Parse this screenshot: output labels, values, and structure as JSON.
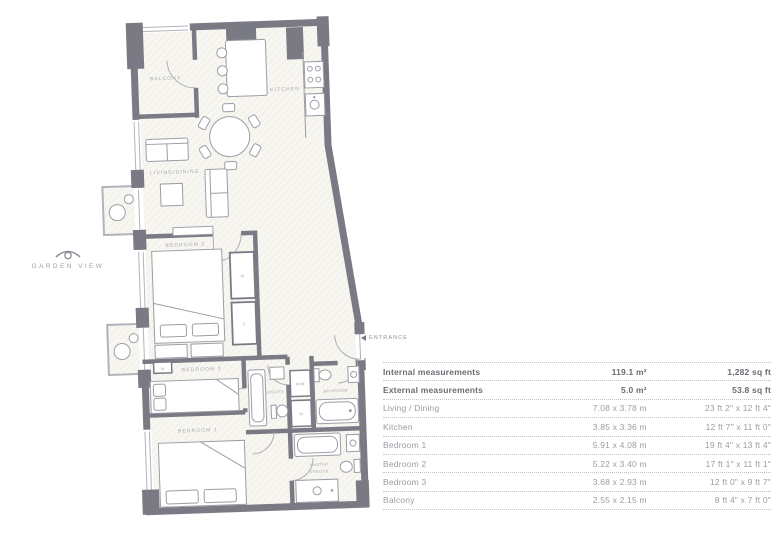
{
  "annotations": {
    "garden_view": "GARDEN VIEW",
    "entrance": "ENTRANCE"
  },
  "floorplan": {
    "rooms": {
      "balcony": "BALCONY",
      "kitchen": "KITCHEN",
      "living_dining": "LIVING/DINING",
      "bedroom2": "BEDROOM 2",
      "bedroom3": "BEDROOM 3",
      "ensuite": "ENSUITE",
      "bathroom": "BATHROOM",
      "bedroom1": "BEDROOM 1",
      "master_line1": "MASTER",
      "master_line2": "ENSUITE"
    },
    "markers": {
      "wardrobe_bed2": "W",
      "cupboard_bed2": "C",
      "wardrobe_bed3": "W",
      "washer": "W/M",
      "wardrobe_hall": "W"
    }
  },
  "table": {
    "rows": [
      {
        "name": "Internal measurements",
        "metric": "119.1 m²",
        "imperial": "1,282 sq ft"
      },
      {
        "name": "External measurements",
        "metric": "5.0 m²",
        "imperial": "53.8 sq ft"
      },
      {
        "name": "Living / Dining",
        "metric": "7.08 x 3.78 m",
        "imperial": "23 ft 2\" x 12 ft 4\""
      },
      {
        "name": "Kitchen",
        "metric": "3.85 x 3.36 m",
        "imperial": "12 ft 7\" x 11 ft 0\""
      },
      {
        "name": "Bedroom 1",
        "metric": "5.91 x 4.08 m",
        "imperial": "19 ft 4\" x 13 ft 4\""
      },
      {
        "name": "Bedroom 2",
        "metric": "5.22 x 3.40 m",
        "imperial": "17 ft 1\" x 11 ft 1\""
      },
      {
        "name": "Bedroom 3",
        "metric": "3.68 x 2.93 m",
        "imperial": "12 ft 0\" x 9 ft 7\""
      },
      {
        "name": "Balcony",
        "metric": "2.55 x 2.15 m",
        "imperial": "8 ft 4\" x 7 ft 0\""
      }
    ]
  },
  "colors": {
    "wall": "#7a7a84",
    "floor_hatch": "#eae7dd",
    "text_muted": "#9c9ca4",
    "text_strong": "#6b6b73",
    "label": "#a8a7ae"
  }
}
